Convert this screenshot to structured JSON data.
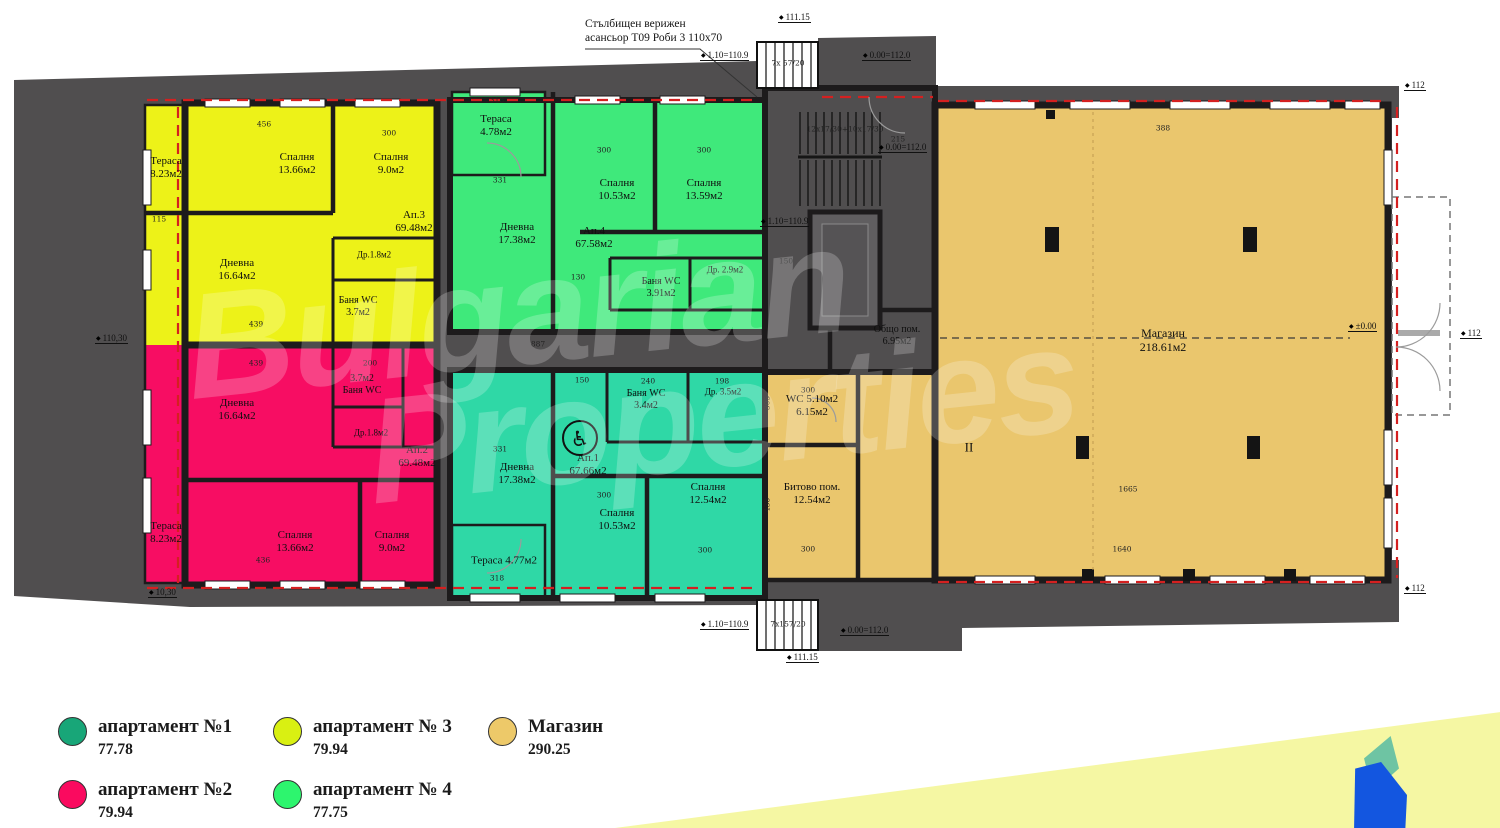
{
  "plan": {
    "note1": "Стълбищен верижен",
    "note2": "асансьор Т09 Роби 3 110x70",
    "watermark1": "Bulgarian",
    "watermark2": "Properties",
    "rooms": [
      {
        "l1": "Тераса",
        "l2": "8.23м2",
        "x": 166,
        "y": 168
      },
      {
        "l1": "Спалня",
        "l2": "13.66м2",
        "x": 297,
        "y": 164
      },
      {
        "l1": "Спалня",
        "l2": "9.0м2",
        "x": 391,
        "y": 164
      },
      {
        "l1": "Дневна",
        "l2": "16.64м2",
        "x": 237,
        "y": 270
      },
      {
        "l1": "Ап.3",
        "l2": "69.48м2",
        "x": 414,
        "y": 222
      },
      {
        "l1": "Др.1.8м2",
        "x": 374,
        "y": 255,
        "size": 9
      },
      {
        "l1": "Баня WC",
        "l2": "3.7м2",
        "x": 358,
        "y": 307,
        "size": 10
      },
      {
        "l1": "Дневна",
        "l2": "16.64м2",
        "x": 237,
        "y": 410
      },
      {
        "l1": "3.7м2",
        "l2": "Баня WC",
        "x": 362,
        "y": 385,
        "size": 10
      },
      {
        "l1": "Др.1.8м2",
        "x": 371,
        "y": 433,
        "size": 9
      },
      {
        "l1": "Ап.2",
        "l2": "69.48м2",
        "x": 417,
        "y": 457
      },
      {
        "l1": "Тераса",
        "l2": "8.23м2",
        "x": 166,
        "y": 533
      },
      {
        "l1": "Спалня",
        "l2": "13.66м2",
        "x": 295,
        "y": 542
      },
      {
        "l1": "Спалня",
        "l2": "9.0м2",
        "x": 392,
        "y": 542
      },
      {
        "l1": "Тераса",
        "l2": "4.78м2",
        "x": 496,
        "y": 126
      },
      {
        "l1": "Дневна",
        "l2": "17.38м2",
        "x": 517,
        "y": 234
      },
      {
        "l1": "Спалня",
        "l2": "10.53м2",
        "x": 617,
        "y": 190
      },
      {
        "l1": "Спалня",
        "l2": "13.59м2",
        "x": 704,
        "y": 190
      },
      {
        "l1": "Ап.4",
        "l2": "67.58м2",
        "x": 594,
        "y": 238
      },
      {
        "l1": "Баня WC",
        "l2": "3.91м2",
        "x": 661,
        "y": 288,
        "size": 10
      },
      {
        "l1": "Др. 2.9м2",
        "x": 725,
        "y": 270,
        "size": 9
      },
      {
        "l1": "Дневна",
        "l2": "17.38м2",
        "x": 517,
        "y": 474
      },
      {
        "l1": "Баня WC",
        "l2": "3.4м2",
        "x": 646,
        "y": 400,
        "size": 10
      },
      {
        "l1": "Др. 3.5м2",
        "x": 723,
        "y": 392,
        "size": 9
      },
      {
        "l1": "Ап.1",
        "l2": "67.66м2",
        "x": 588,
        "y": 465
      },
      {
        "l1": "Спалня",
        "l2": "10.53м2",
        "x": 617,
        "y": 520
      },
      {
        "l1": "Спалня",
        "l2": "12.54м2",
        "x": 708,
        "y": 494
      },
      {
        "l1": "Тераса 4.77м2",
        "x": 504,
        "y": 561
      },
      {
        "l1": "Общо пом.",
        "l2": "6.95м2",
        "x": 897,
        "y": 336,
        "size": 10
      },
      {
        "l1": "WC 5.10м2",
        "l2": "6.15м2",
        "x": 812,
        "y": 406
      },
      {
        "l1": "Битово пом.",
        "l2": "12.54м2",
        "x": 812,
        "y": 494
      },
      {
        "l1": "Магазин",
        "l2": "218.61м2",
        "x": 1163,
        "y": 340,
        "size": 12
      },
      {
        "l1": "II",
        "x": 969,
        "y": 447,
        "size": 13
      }
    ],
    "dims": [
      {
        "t": "456",
        "x": 264,
        "y": 124
      },
      {
        "t": "300",
        "x": 389,
        "y": 133
      },
      {
        "t": "115",
        "x": 159,
        "y": 219
      },
      {
        "t": "439",
        "x": 256,
        "y": 324
      },
      {
        "t": "318",
        "x": 497,
        "y": 100
      },
      {
        "t": "331",
        "x": 500,
        "y": 180
      },
      {
        "t": "300",
        "x": 604,
        "y": 150
      },
      {
        "t": "300",
        "x": 704,
        "y": 150
      },
      {
        "t": "130",
        "x": 578,
        "y": 277
      },
      {
        "t": "887",
        "x": 538,
        "y": 344
      },
      {
        "t": "439",
        "x": 256,
        "y": 363
      },
      {
        "t": "200",
        "x": 370,
        "y": 363
      },
      {
        "t": "436",
        "x": 263,
        "y": 560
      },
      {
        "t": "150",
        "x": 582,
        "y": 380
      },
      {
        "t": "240",
        "x": 648,
        "y": 381
      },
      {
        "t": "198",
        "x": 722,
        "y": 381
      },
      {
        "t": "331",
        "x": 500,
        "y": 449
      },
      {
        "t": "300",
        "x": 604,
        "y": 495
      },
      {
        "t": "300",
        "x": 705,
        "y": 550
      },
      {
        "t": "318",
        "x": 497,
        "y": 578
      },
      {
        "t": "300",
        "x": 808,
        "y": 390
      },
      {
        "t": "300",
        "x": 808,
        "y": 549
      },
      {
        "t": "305",
        "x": 767,
        "y": 403,
        "v": 1
      },
      {
        "t": "438",
        "x": 767,
        "y": 505,
        "v": 1
      },
      {
        "t": "388",
        "x": 1163,
        "y": 128
      },
      {
        "t": "1665",
        "x": 1128,
        "y": 489
      },
      {
        "t": "1640",
        "x": 1122,
        "y": 549
      },
      {
        "t": "215",
        "x": 898,
        "y": 139
      },
      {
        "t": "150",
        "x": 786,
        "y": 261
      },
      {
        "t": "7x 57/20",
        "x": 788,
        "y": 63
      },
      {
        "t": "12x17/30+10x17/30",
        "x": 845,
        "y": 129
      },
      {
        "t": "7x157/20",
        "x": 788,
        "y": 624
      }
    ],
    "elevs": [
      {
        "t": "111.15",
        "x": 778,
        "y": 12
      },
      {
        "t": "1.10=110.9",
        "x": 700,
        "y": 50
      },
      {
        "t": "0.00=112.0",
        "x": 862,
        "y": 50
      },
      {
        "t": "112",
        "x": 1404,
        "y": 80
      },
      {
        "t": "0.00=112.0",
        "x": 878,
        "y": 142
      },
      {
        "t": "1.10=110.9",
        "x": 760,
        "y": 216
      },
      {
        "t": "110,30",
        "x": 95,
        "y": 333
      },
      {
        "t": "10,30",
        "x": 148,
        "y": 587
      },
      {
        "t": "1.10=110.9",
        "x": 700,
        "y": 619
      },
      {
        "t": "0.00=112.0",
        "x": 840,
        "y": 625
      },
      {
        "t": "111.15",
        "x": 786,
        "y": 652
      },
      {
        "t": "±0.00",
        "x": 1348,
        "y": 321
      },
      {
        "t": "112",
        "x": 1460,
        "y": 328
      },
      {
        "t": "112",
        "x": 1404,
        "y": 583
      }
    ]
  },
  "legend": {
    "items": [
      {
        "label": "апартамент №1",
        "value": "77.78",
        "color": "#18a678",
        "x": 58,
        "y": 716
      },
      {
        "label": "апартамент № 3",
        "value": "79.94",
        "color": "#d9f012",
        "x": 273,
        "y": 716
      },
      {
        "label": "Магазин",
        "value": "290.25",
        "color": "#edc969",
        "x": 488,
        "y": 716
      },
      {
        "label": "апартамент №2",
        "value": "79.94",
        "color": "#fa0a5f",
        "x": 58,
        "y": 779
      },
      {
        "label": "апартамент № 4",
        "value": "77.75",
        "color": "#2df56e",
        "x": 273,
        "y": 779
      }
    ]
  },
  "colors": {
    "apartment1_fill": "#2fd8a6",
    "apartment2_fill": "#f70d63",
    "apartment3_fill": "#edf218",
    "apartment4_fill": "#3fe97b",
    "shop_fill": "#eac66d",
    "slab": "#504e4f",
    "red_insulation_line": "#d42020",
    "accent_band": "#f5f7a3",
    "logo_blue": "#1356e0",
    "logo_green": "#6ec4a3"
  }
}
